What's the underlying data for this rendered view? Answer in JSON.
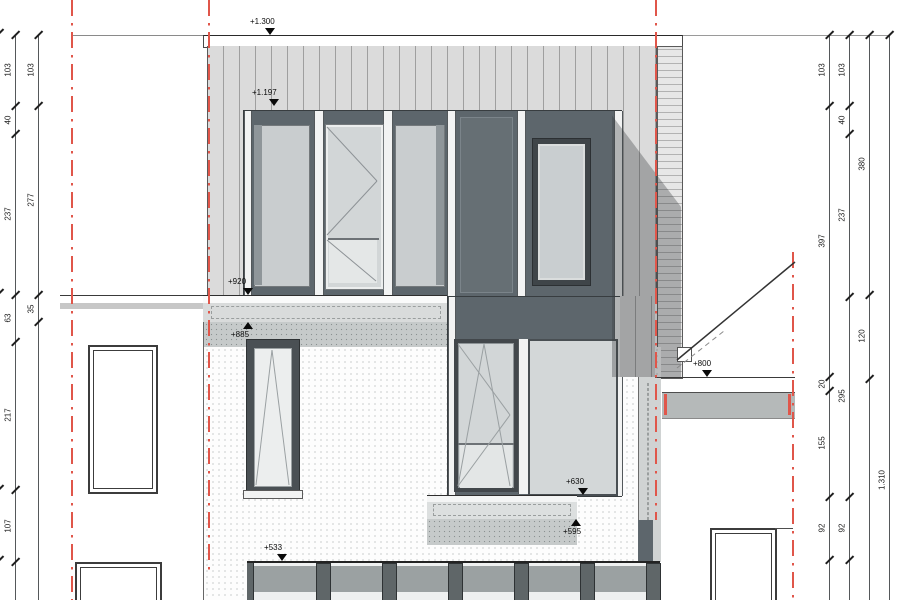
{
  "drawing": {
    "kind": "architectural street elevation",
    "colors": {
      "boundary_red": "#e0564a",
      "siding_light": "#dbdbdb",
      "window_band_dark": "#5d666c",
      "glass": "#ccd1d3",
      "fascia_gray": "#b5b9b9",
      "line": "#3a3f42"
    },
    "elevation_markers": [
      {
        "label": "+1.300",
        "direction": "down"
      },
      {
        "label": "+1.197",
        "direction": "down"
      },
      {
        "label": "+920",
        "direction": "down"
      },
      {
        "label": "+885",
        "direction": "up"
      },
      {
        "label": "+800",
        "direction": "down"
      },
      {
        "label": "+630",
        "direction": "down"
      },
      {
        "label": "+595",
        "direction": "up"
      },
      {
        "label": "+533",
        "direction": "down"
      }
    ],
    "dimensions": {
      "left_inner": [
        "103",
        "40",
        "237",
        "63",
        "217",
        "107"
      ],
      "left_outer": [
        "103",
        "277",
        "35"
      ],
      "right_line1": [
        "103",
        "397",
        "20",
        "155",
        "92"
      ],
      "right_line2": [
        "103",
        "40",
        "237",
        "295",
        "92"
      ],
      "right_line3": [
        "380",
        "120"
      ],
      "right_line4": [
        "1.310"
      ]
    }
  }
}
